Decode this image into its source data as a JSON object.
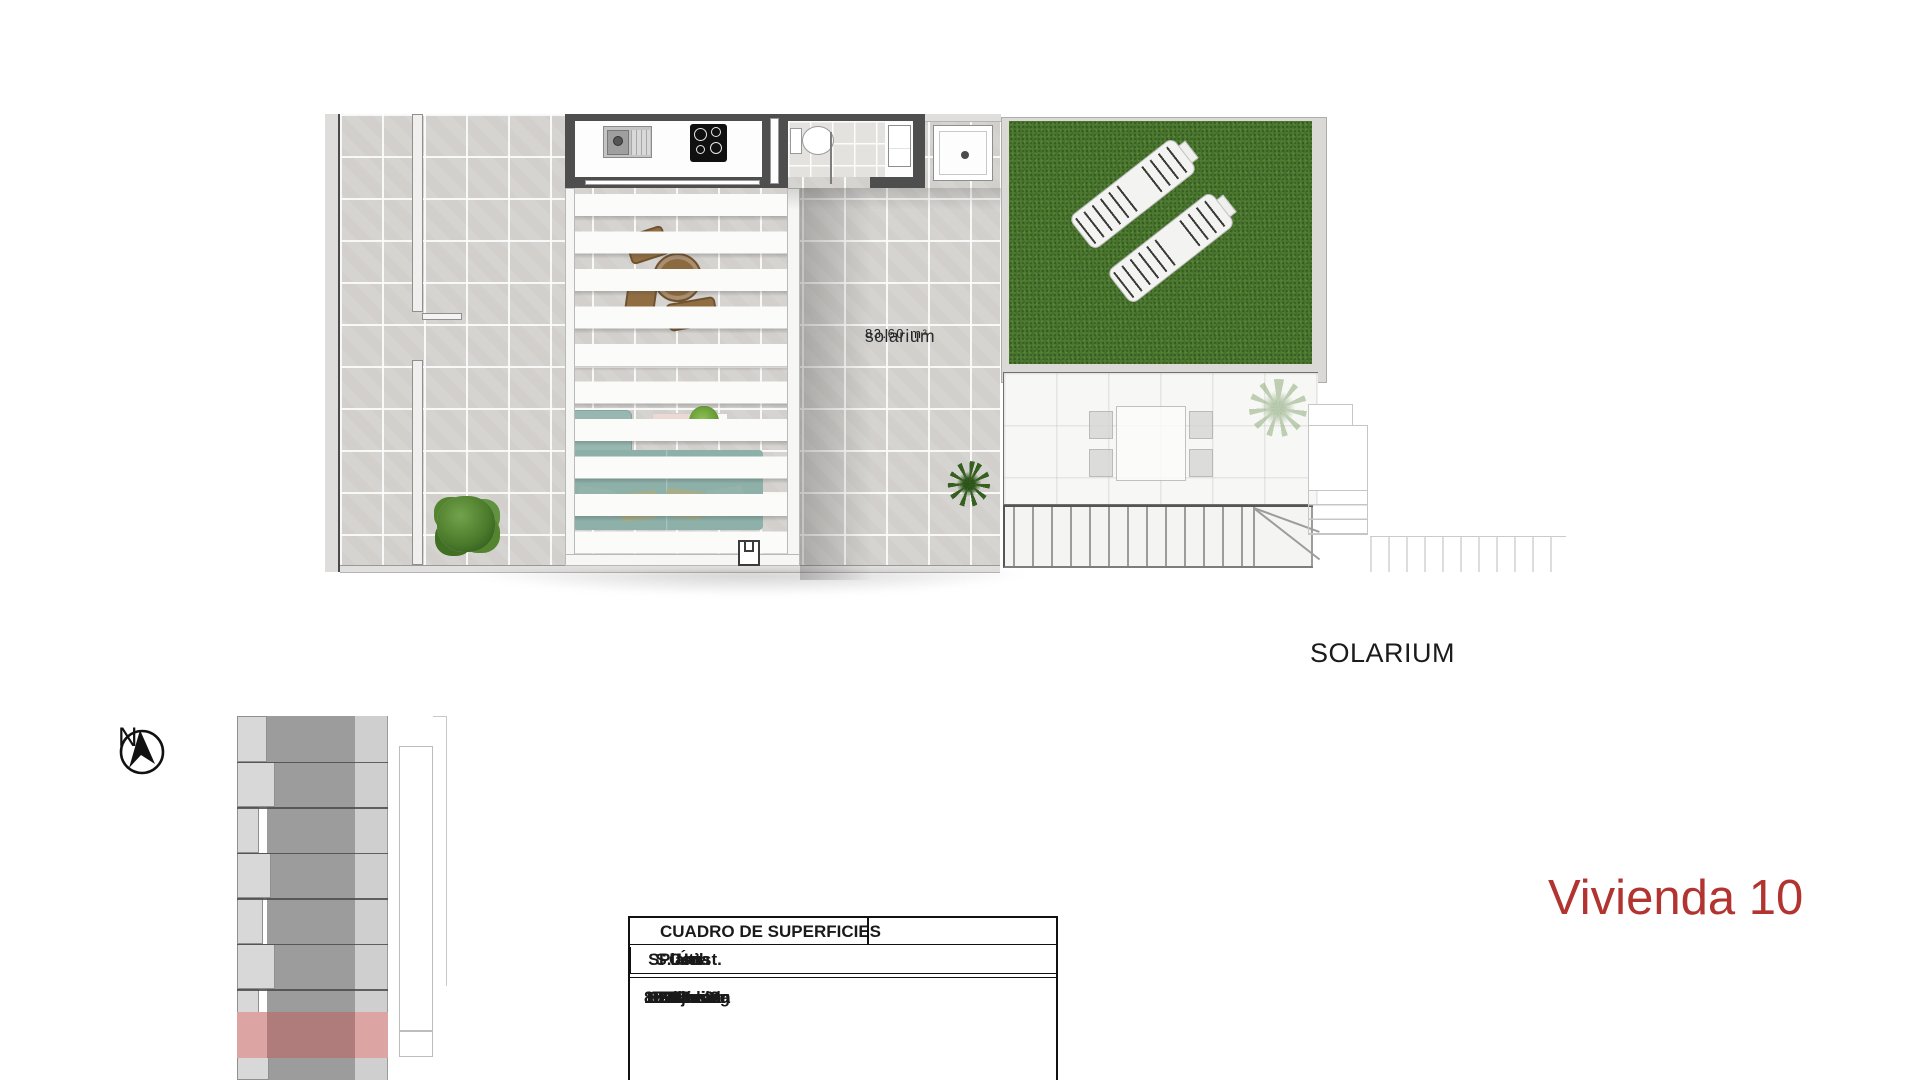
{
  "page": {
    "title": "Vivienda 10"
  },
  "plan": {
    "room_label": "solarium",
    "room_area": "83.60 m²",
    "level_label": "SOLARIUM"
  },
  "compass": {
    "label": "N"
  },
  "icons": {
    "compass": "north-arrow-icon"
  },
  "surfaces_table": {
    "title": "CUADRO DE SUPERFICIES",
    "columns": [
      "Planta",
      "Uso",
      "S. Útil",
      "S. Const."
    ],
    "rows": [
      [
        "Baja",
        "Parking",
        "17.90 m2",
        "17.90 m2"
      ],
      [
        "Primera",
        "Vivienda",
        "80.55 m2",
        "92.31 m2"
      ],
      [
        "Primera",
        "Terraza",
        "15.30 m2",
        "15.30 m2"
      ],
      [
        "Solarium",
        "Solarium",
        "83.60 m2",
        "83.60 m2"
      ]
    ]
  },
  "colors": {
    "accent_red": "#b23431",
    "grass_green": "#4c7931",
    "tile_gray": "#d6d4d1",
    "wall_gray": "#4e4e4e",
    "highlight_pink": "#dda4a4",
    "highlight_rose": "#b07b7b"
  }
}
